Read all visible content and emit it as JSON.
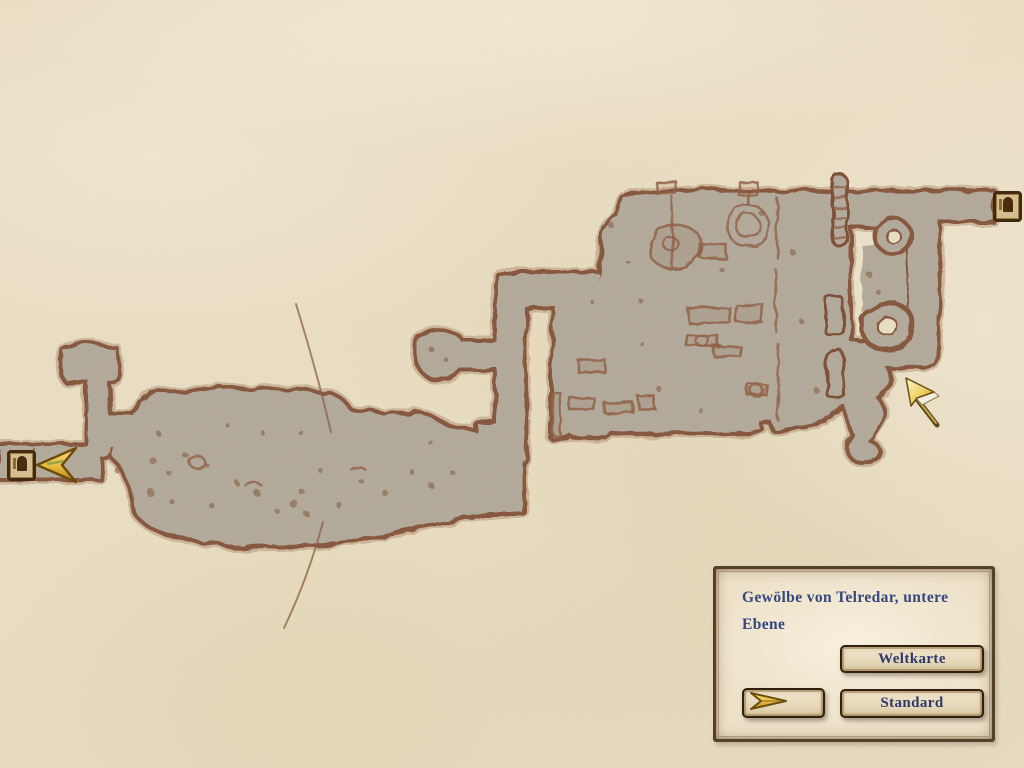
{
  "info_panel": {
    "location_title": "Gewölbe von Telredar, untere Ebene",
    "buttons": {
      "world_map_label": "Weltkarte",
      "standard_label": "Standard"
    }
  },
  "icons": {
    "west_door": "door-icon",
    "northeast_door": "door-icon",
    "player_marker": "player-arrow-icon",
    "map_mode_arrow": "gold-arrow-icon",
    "cursor": "cursor-arrow-icon"
  },
  "colors": {
    "parchment": "#e9ddc2",
    "map_fill": "#b2a99a",
    "map_outline": "#85573c",
    "title_text": "#36477e",
    "button_text": "#2e3a6a",
    "gold_accent": "#e8b93e",
    "frame_brown": "#43290f"
  }
}
